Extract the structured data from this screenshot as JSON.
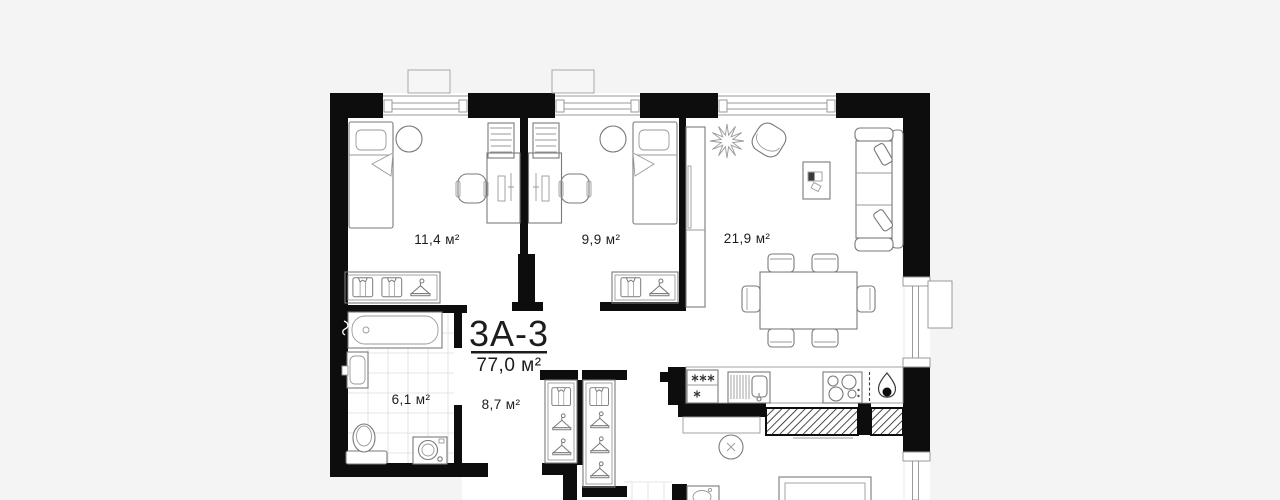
{
  "plan": {
    "title": "3А-3",
    "total_area": "77,0 м²",
    "rooms": [
      {
        "name": "bedroom-1",
        "area": "11,4 м²"
      },
      {
        "name": "bedroom-2",
        "area": "9,9 м²"
      },
      {
        "name": "living-room-kitchen",
        "area": "21,9 м²"
      },
      {
        "name": "bathroom",
        "area": "6,1 м²"
      },
      {
        "name": "hallway",
        "area": "8,7 м²"
      }
    ],
    "colors": {
      "background": "#f4f4f4",
      "walls": "#0d0d0d",
      "floor": "#ffffff",
      "furniture_line": "#7a7a7a"
    }
  }
}
